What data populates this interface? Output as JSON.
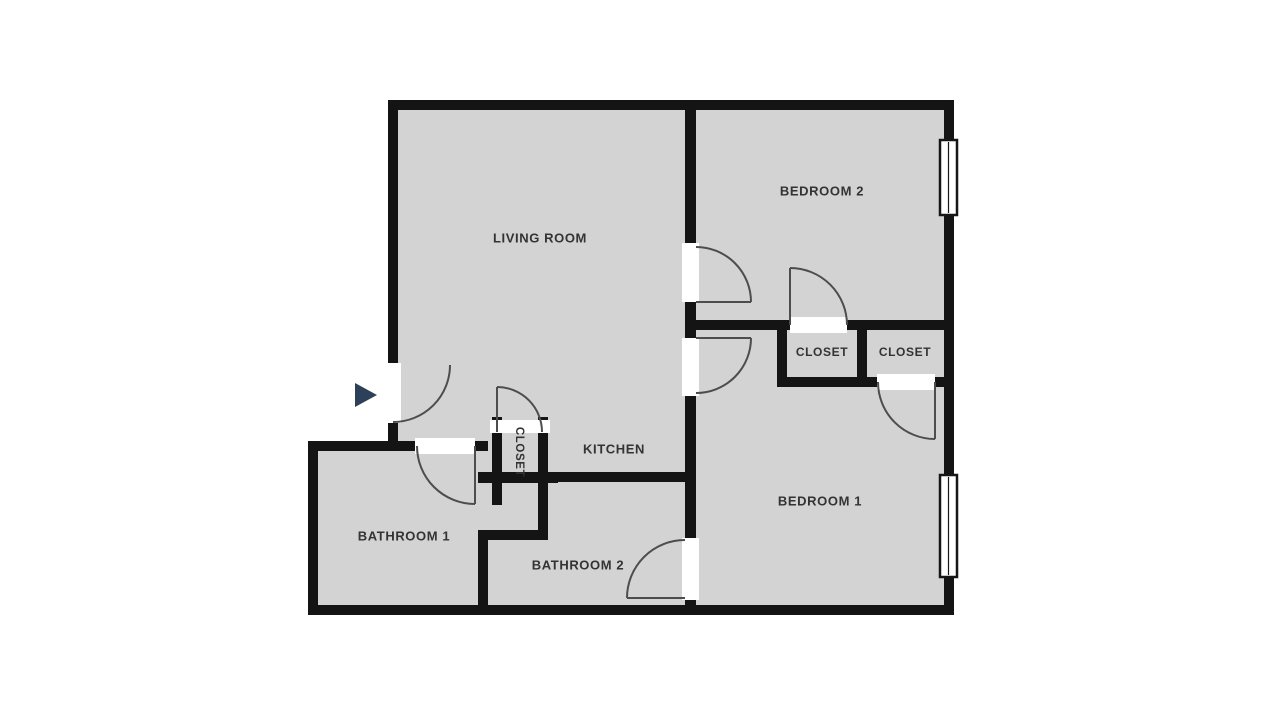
{
  "title": "Apartment floor plan",
  "colors": {
    "floor": "#d3d3d3",
    "wall": "#141414",
    "door_arc": "#4d4d4d",
    "entry_marker": "#2d4059",
    "label": "#333333"
  },
  "rooms": {
    "living_room": {
      "label": "LIVING ROOM"
    },
    "bedroom_2": {
      "label": "BEDROOM 2"
    },
    "bedroom_1": {
      "label": "BEDROOM 1"
    },
    "kitchen": {
      "label": "KITCHEN"
    },
    "bathroom_1": {
      "label": "BATHROOM 1"
    },
    "bathroom_2": {
      "label": "BATHROOM 2"
    },
    "closet_bedroom_2": {
      "label": "CLOSET"
    },
    "closet_bedroom_1": {
      "label": "CLOSET"
    },
    "closet_hall": {
      "label": "CLOSET"
    }
  }
}
